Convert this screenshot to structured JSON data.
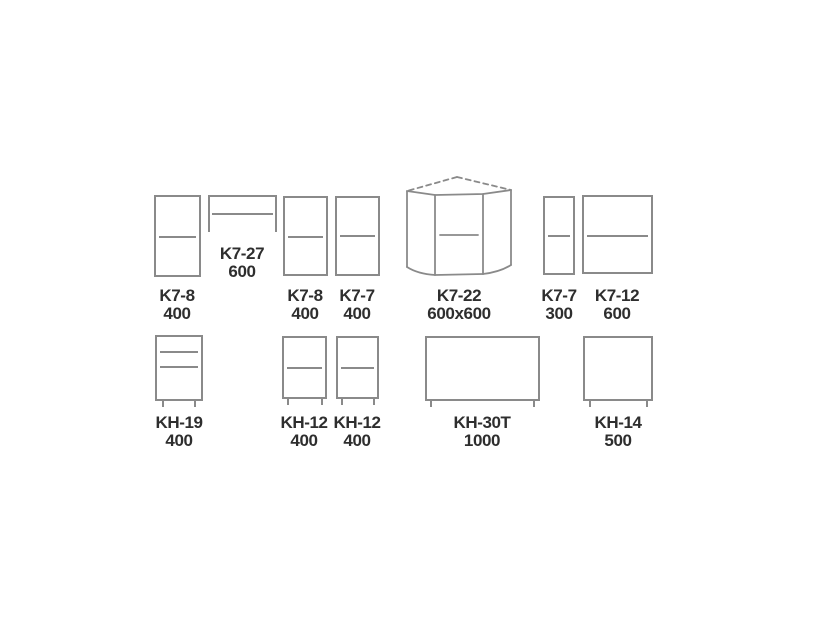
{
  "diagram": {
    "type": "kitchen-cabinet-module-schematic",
    "rows": 2
  },
  "colors": {
    "line": "#8a8a8a",
    "text": "#2e2e2e",
    "background": "#ffffff"
  },
  "cabinets": {
    "top": [
      {
        "model": "K7-8",
        "size": "400"
      },
      {
        "model": "K7-27",
        "size": "600"
      },
      {
        "model": "K7-8",
        "size": "400"
      },
      {
        "model": "K7-7",
        "size": "400"
      },
      {
        "model": "K7-22",
        "size": "600x600"
      },
      {
        "model": "K7-7",
        "size": "300"
      },
      {
        "model": "K7-12",
        "size": "600"
      }
    ],
    "bottom": [
      {
        "model": "KH-19",
        "size": "400"
      },
      {
        "model": "KH-12",
        "size": "400"
      },
      {
        "model": "KH-12",
        "size": "400"
      },
      {
        "model": "KH-30T",
        "size": "1000"
      },
      {
        "model": "KH-14",
        "size": "500"
      }
    ]
  }
}
